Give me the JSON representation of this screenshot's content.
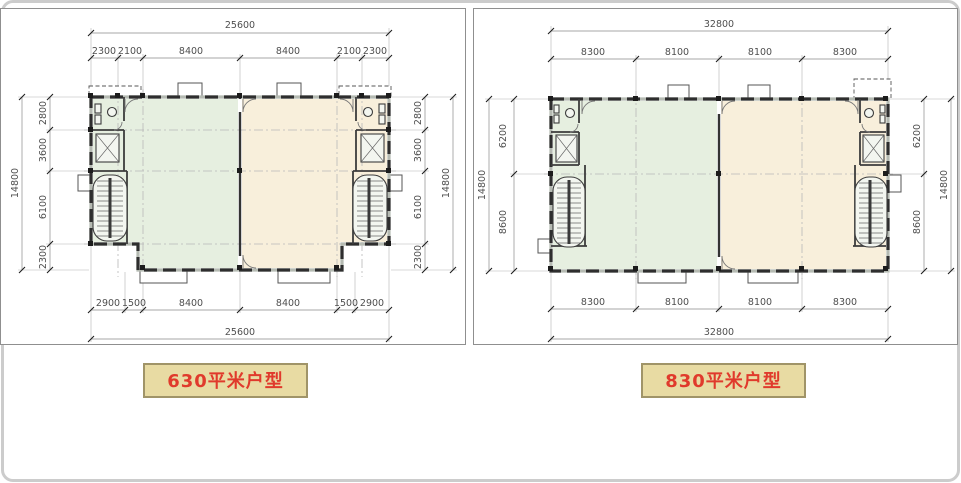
{
  "page": {
    "background": "#ffffff",
    "frame_color": "#cccccc",
    "panel_border_color": "#8f8f8f"
  },
  "colors": {
    "room_green": "#e6efe0",
    "room_tan": "#f8efdb",
    "wall": "#2e2e2e",
    "dim_text": "#4f4f4f",
    "label_bg": "#e8dba3",
    "label_border": "#a09468",
    "label_text": "#e03a2c"
  },
  "plans": {
    "p630": {
      "title": "630平米户型",
      "top_total": "25600",
      "top_segments": [
        "2300",
        "2100",
        "8400",
        "8400",
        "2100",
        "2300"
      ],
      "bottom_segments": [
        "2900",
        "1500",
        "8400",
        "8400",
        "1500",
        "2900"
      ],
      "bottom_total": "25600",
      "left_total": "14800",
      "left_segments": [
        "2800",
        "3600",
        "6100",
        "2300"
      ],
      "right_segments": [
        "2800",
        "3600",
        "6100",
        "2300"
      ],
      "right_total": "14800"
    },
    "p830": {
      "title": "830平米户型",
      "top_total": "32800",
      "top_segments": [
        "8300",
        "8100",
        "8100",
        "8300"
      ],
      "bottom_segments": [
        "8300",
        "8100",
        "8100",
        "8300"
      ],
      "bottom_total": "32800",
      "left_total": "14800",
      "left_segments": [
        "6200",
        "8600"
      ],
      "right_segments": [
        "6200",
        "8600"
      ],
      "right_total": "14800"
    }
  }
}
